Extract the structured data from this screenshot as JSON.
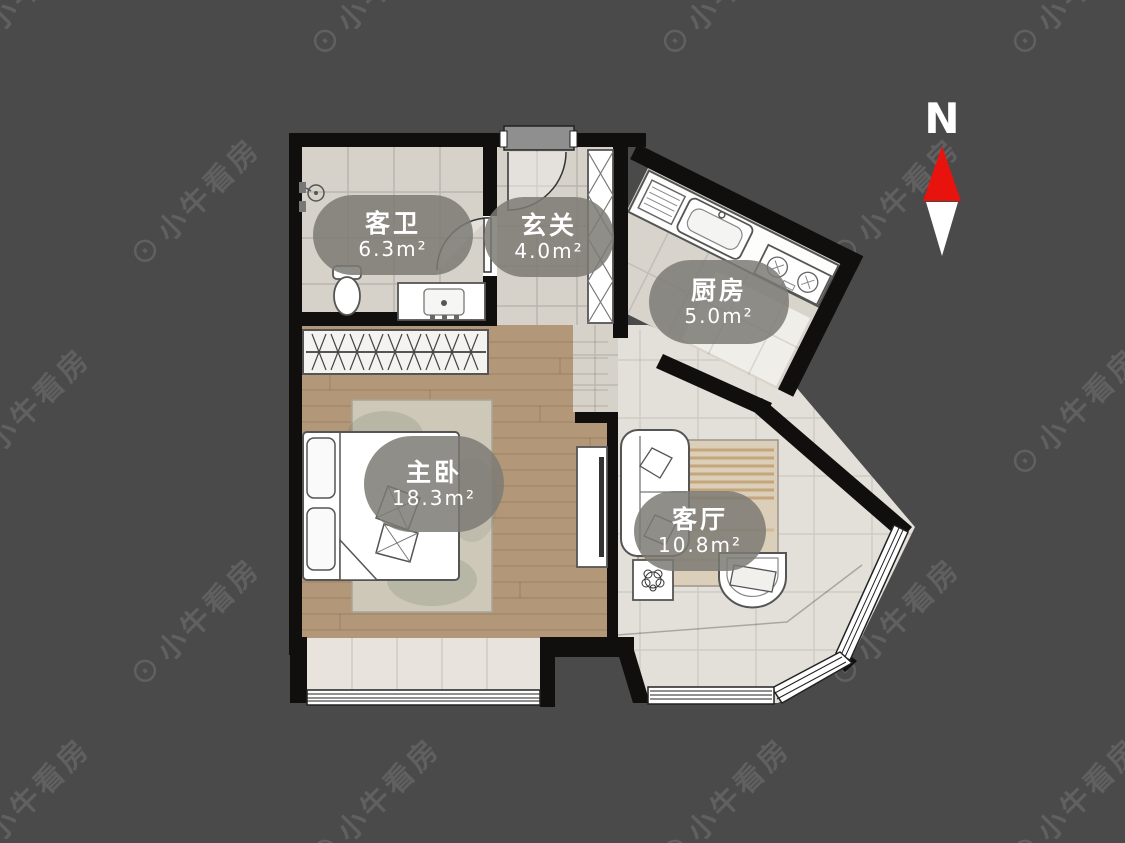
{
  "page": {
    "background_color": "#4a4a4b",
    "width": 1125,
    "height": 843
  },
  "watermark": {
    "logo_glyph": "⊙",
    "text": "小牛看房"
  },
  "compass": {
    "north_label": "N",
    "north_color": "#e8130c",
    "south_color": "#ffffff"
  },
  "floor_plan": {
    "wall_color": "#100f0d",
    "floor_colors": {
      "tile": "#d6d2ca",
      "wood": "#b29878",
      "living_tile": "#e3dfd9",
      "bay_sill": "#e8e3dd"
    },
    "label_bubble_color": "rgba(124,122,116,0.85)",
    "rooms": [
      {
        "id": "guest-bathroom",
        "name": "客卫",
        "area": "6.3m²"
      },
      {
        "id": "foyer",
        "name": "玄关",
        "area": "4.0m²"
      },
      {
        "id": "kitchen",
        "name": "厨房",
        "area": "5.0m²"
      },
      {
        "id": "master-bedroom",
        "name": "主卧",
        "area": "18.3m²"
      },
      {
        "id": "living-room",
        "name": "客厅",
        "area": "10.8m²"
      }
    ]
  }
}
